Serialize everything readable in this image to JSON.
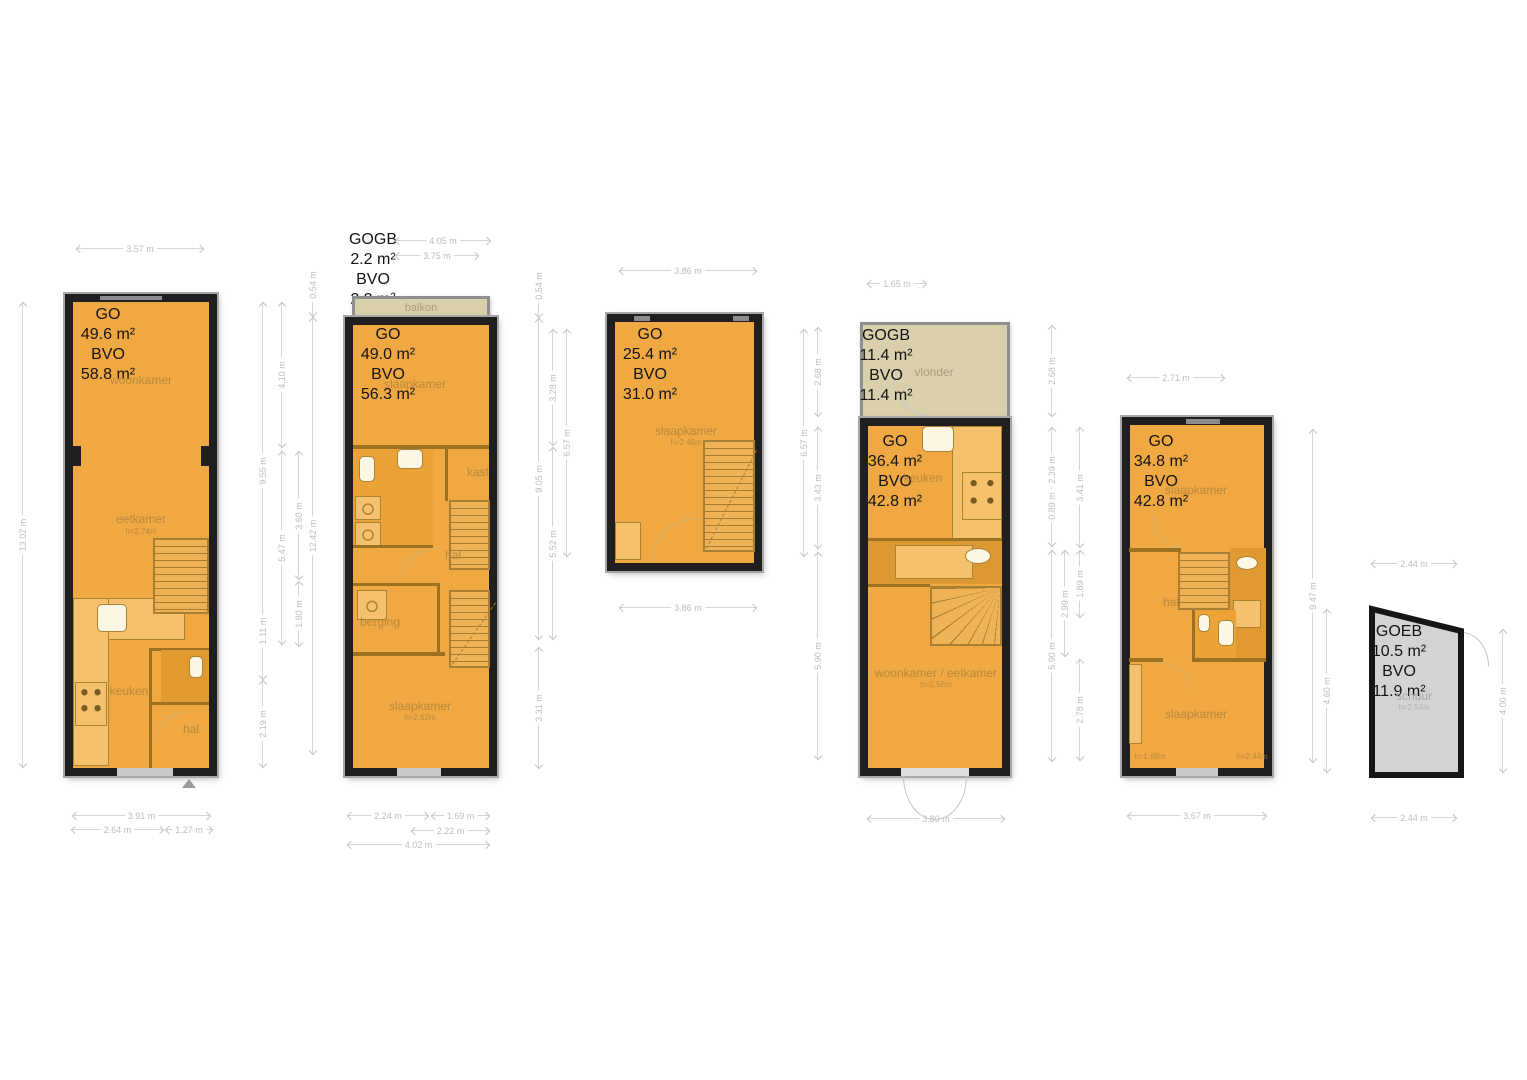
{
  "page": {
    "background": "#ffffff"
  },
  "colors": {
    "room_fill": "#f0a843",
    "wall": "#1f1f1f",
    "deck_fill": "#d9cfab",
    "shed_fill": "#d3d3d3",
    "dim_text": "#bdbdbd"
  },
  "plans": {
    "p1": {
      "area": {
        "go_label": "GO",
        "go_value": "49.6 m²",
        "bvo_label": "BVO",
        "bvo_value": "58.8 m²"
      },
      "rooms": {
        "woonkamer": "woonkamer",
        "eetkamer": "eetkamer",
        "eetkamer_h": "h=2.74m",
        "keuken": "keuken",
        "hal": "hal"
      },
      "dims": {
        "top": "3.57 m",
        "left": "13.02 m",
        "b1": "3.91 m",
        "b2": "2.64 m",
        "b3": "1.27 m",
        "rA1": "9.55 m",
        "rA2": "1.11 m",
        "rA3": "2.19 m",
        "rB1": "4.10 m",
        "rB2": "5.47 m",
        "rC1": "3.60 m",
        "rC2": "1.80 m",
        "rD1": "0.54 m",
        "rD2": "12.42 m"
      }
    },
    "p2": {
      "gogb": {
        "title": "GOGB",
        "value": "2.2 m²",
        "bvo_label": "BVO",
        "bvo_value": "2.2 m²"
      },
      "balcony_label": "balkon",
      "area": {
        "go_label": "GO",
        "go_value": "49.0 m²",
        "bvo_label": "BVO",
        "bvo_value": "56.3 m²"
      },
      "rooms": {
        "slaapkamer_top": "slaapkamer",
        "kast": "kast",
        "hal": "hal",
        "berging": "berging",
        "slaapkamer_bottom": "slaapkamer",
        "slaapkamer_bottom_h": "h=2.62m"
      },
      "dims": {
        "t1": "4.05 m",
        "t2": "3.75 m",
        "b1": "2.24 m",
        "b2": "1.69 m",
        "b3": "2.22 m",
        "b4": "4.02 m",
        "rA1": "0.54 m",
        "rA2": "9.05 m",
        "rA3": "3.31 m",
        "rB1": "3.28 m",
        "rB2": "5.52 m",
        "rC1": "6.57 m"
      }
    },
    "p3": {
      "area": {
        "go_label": "GO",
        "go_value": "25.4 m²",
        "bvo_label": "BVO",
        "bvo_value": "31.0 m²"
      },
      "rooms": {
        "slaapkamer": "slaapkamer",
        "slaapkamer_h": "h=2.46m"
      },
      "dims": {
        "top": "3.86 m",
        "bottom": "3.86 m",
        "r1": "6.57 m"
      }
    },
    "p4": {
      "gogb": {
        "title": "GOGB",
        "value": "11.4 m²",
        "bvo_label": "BVO",
        "bvo_value": "11.4 m²"
      },
      "vlonder_label": "vlonder",
      "area": {
        "go_label": "GO",
        "go_value": "36.4 m²",
        "bvo_label": "BVO",
        "bvo_value": "42.8 m²"
      },
      "rooms": {
        "keuken": "keuken",
        "woonkamer": "woonkamer / eetkamer",
        "woonkamer_h": "h=2.56m"
      },
      "dims": {
        "top": "1.65 m",
        "bottom": "3.80 m",
        "lA1": "2.68 m",
        "lA2": "3.43 m",
        "lA3": "5.90 m",
        "rA1": "2.68 m",
        "rA2": "2.39 m",
        "rA3": "0.89 m",
        "rA4": "5.90 m",
        "rB1": "2.99 m",
        "rC1": "3.41 m",
        "rC2": "1.89 m",
        "rC3": "2.78 m"
      }
    },
    "p5": {
      "area": {
        "go_label": "GO",
        "go_value": "34.8 m²",
        "bvo_label": "BVO",
        "bvo_value": "42.8 m²"
      },
      "rooms": {
        "slaapkamer_top": "slaapkamer",
        "hal": "hal",
        "slaapkamer_bottom": "slaapkamer",
        "h_left": "h=1.98m",
        "h_right": "h=2.44m"
      },
      "dims": {
        "top": "2.71 m",
        "bottom": "3.67 m",
        "r1": "9.47 m",
        "r2": "4.60 m"
      }
    },
    "p6": {
      "area": {
        "title": "GOEB",
        "value": "10.5 m²",
        "bvo_label": "BVO",
        "bvo_value": "11.9 m²"
      },
      "rooms": {
        "schuur": "schuur",
        "schuur_h": "h=2.54m"
      },
      "dims": {
        "top": "2.44 m",
        "bottom": "2.44 m",
        "right": "4.00 m"
      }
    }
  }
}
